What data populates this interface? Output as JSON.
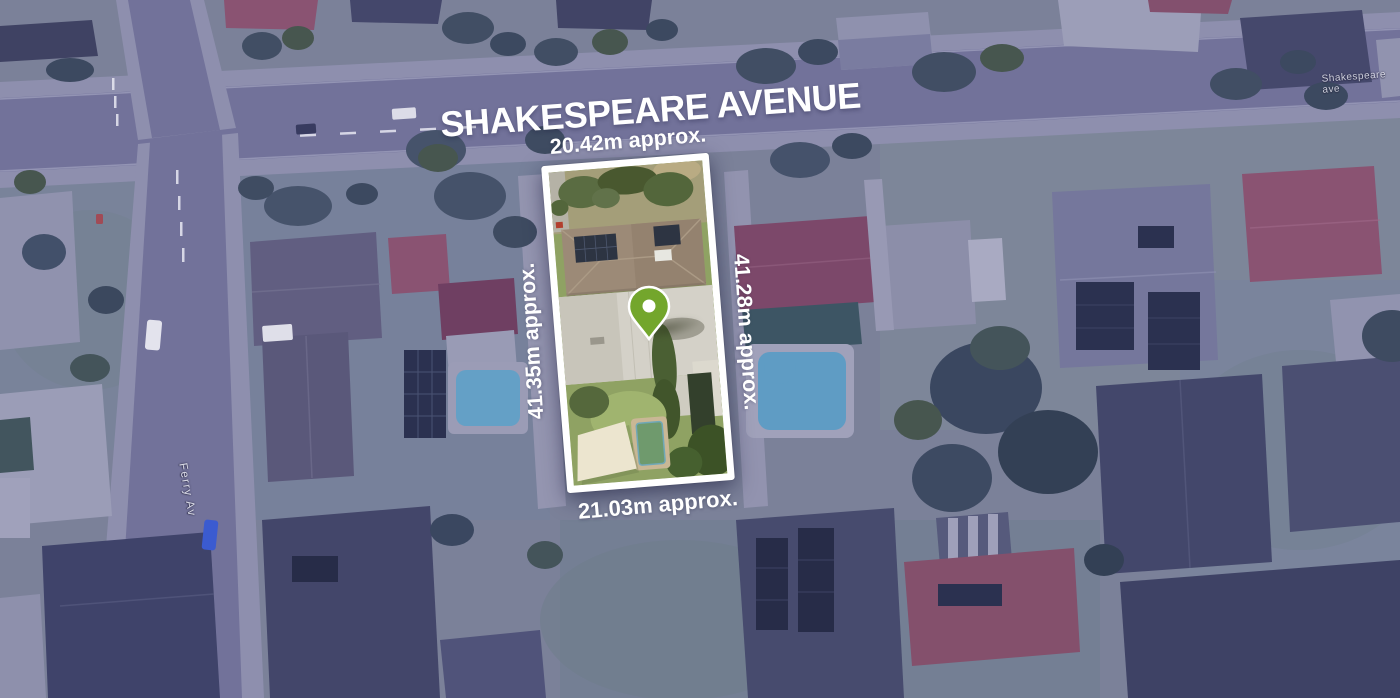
{
  "map": {
    "overlay_tint_color": "#3e3d7a",
    "road_labels": {
      "shakespeare_avenue_small": "Shakespeare ave",
      "ferry_av": "Ferry Av"
    }
  },
  "annotations": {
    "street_title": "SHAKESPEARE AVENUE",
    "dim_top": "20.42m approx.",
    "dim_left": "41.35m approx.",
    "dim_right": "41.28m approx.",
    "dim_bottom": "21.03m approx."
  },
  "marker": {
    "pin_color": "#73a62c",
    "pin_ring_color": "#ffffff"
  },
  "parcel": {
    "border_color": "#ffffff"
  }
}
